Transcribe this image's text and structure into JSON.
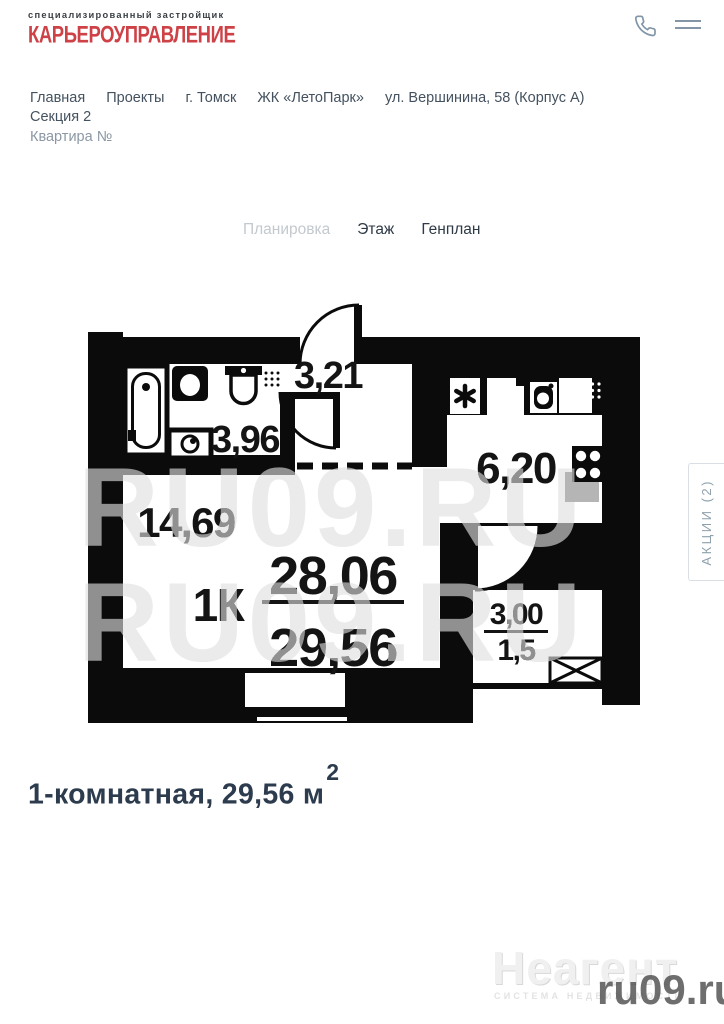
{
  "header": {
    "logo_top": "специализированный застройщик",
    "logo_main": "КАРЬЕРОУПРАВЛЕНИЕ",
    "icons": {
      "phone": "phone-icon",
      "menu": "hamburger-menu-icon"
    }
  },
  "breadcrumb": {
    "items": [
      "Главная",
      "Проекты",
      "г. Томск",
      "ЖК «ЛетоПарк»",
      "ул. Вершинина, 58 (Корпус А)",
      "Секция 2"
    ],
    "current": "Квартира №"
  },
  "tabs": [
    {
      "label": "Планировка",
      "active": true
    },
    {
      "label": "Этаж",
      "active": false
    },
    {
      "label": "Генплан",
      "active": false
    }
  ],
  "floorplan": {
    "hall_area": "3,21",
    "bathroom_area": "3,96",
    "kitchen_area": "6,20",
    "living_area": "14,69",
    "type_label": "1К",
    "area_main": "28,06",
    "area_total": "29,56",
    "balcony_area": "3,00",
    "balcony_reduced": "1,5"
  },
  "promo_tab": {
    "label": "АКЦИИ (2)"
  },
  "summary": {
    "title": "1-комнатная, 29,56 м",
    "sup": "2"
  },
  "watermarks": {
    "plan": "RU09.RU",
    "agency": "Неагент",
    "agency_sub": "СИСТЕМА НЕДВИЖИМОСТИ",
    "site": "ru09.ru"
  },
  "colors": {
    "brand_red": "#ce4247",
    "text_dark": "#2c3b4d",
    "muted": "#8fa1ad",
    "plan_ink": "#0b0b0b"
  }
}
